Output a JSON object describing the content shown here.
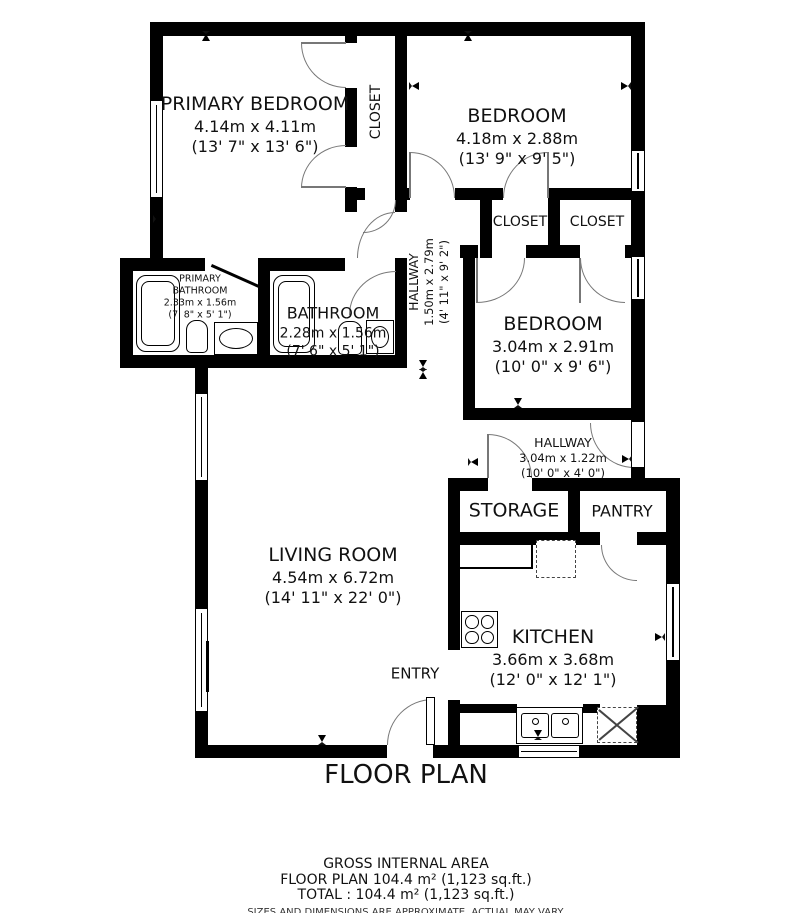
{
  "title": "FLOOR PLAN",
  "rooms": {
    "primary_bedroom": {
      "name": "PRIMARY BEDROOM",
      "metric": "4.14m x 4.11m",
      "imperial": "(13' 7\" x 13' 6\")"
    },
    "bedroom_top": {
      "name": "BEDROOM",
      "metric": "4.18m x 2.88m",
      "imperial": "(13' 9\" x 9' 5\")"
    },
    "bedroom_mid": {
      "name": "BEDROOM",
      "metric": "3.04m x 2.91m",
      "imperial": "(10' 0\" x 9' 6\")"
    },
    "closet_vertical": {
      "name": "CLOSET"
    },
    "closet_left": {
      "name": "CLOSET"
    },
    "closet_right": {
      "name": "CLOSET"
    },
    "hallway_upper": {
      "name": "HALLWAY",
      "metric": "1.50m x 2.79m",
      "imperial": "(4' 11\" x 9' 2\")"
    },
    "hallway_lower": {
      "name": "HALLWAY",
      "metric": "3.04m x 1.22m",
      "imperial": "(10' 0\" x 4' 0\")"
    },
    "primary_bathroom": {
      "name_line1": "PRIMARY",
      "name_line2": "BATHROOM",
      "metric": "2.33m x 1.56m",
      "imperial": "(7' 8\" x 5' 1\")"
    },
    "bathroom": {
      "name": "BATHROOM",
      "metric": "2.28m x 1.56m",
      "imperial": "(7' 6\" x 5' 1\")"
    },
    "living_room": {
      "name": "LIVING ROOM",
      "metric": "4.54m x 6.72m",
      "imperial": "(14' 11\" x 22' 0\")"
    },
    "kitchen": {
      "name": "KITCHEN",
      "metric": "3.66m x 3.68m",
      "imperial": "(12' 0\" x 12' 1\")"
    },
    "storage": {
      "name": "STORAGE"
    },
    "pantry": {
      "name": "PANTRY"
    },
    "entry": {
      "name": "ENTRY"
    }
  },
  "footer": {
    "gross": "GROSS INTERNAL AREA",
    "floor_plan_line": "FLOOR PLAN 104.4 m² (1,123 sq.ft.)",
    "total_line": "TOTAL :  104.4 m² (1,123 sq.ft.)",
    "disclaimer": "SIZES AND DIMENSIONS ARE APPROXIMATE, ACTUAL MAY VARY."
  },
  "colors": {
    "wall": "#000000",
    "background": "#ffffff",
    "text": "#111111"
  }
}
